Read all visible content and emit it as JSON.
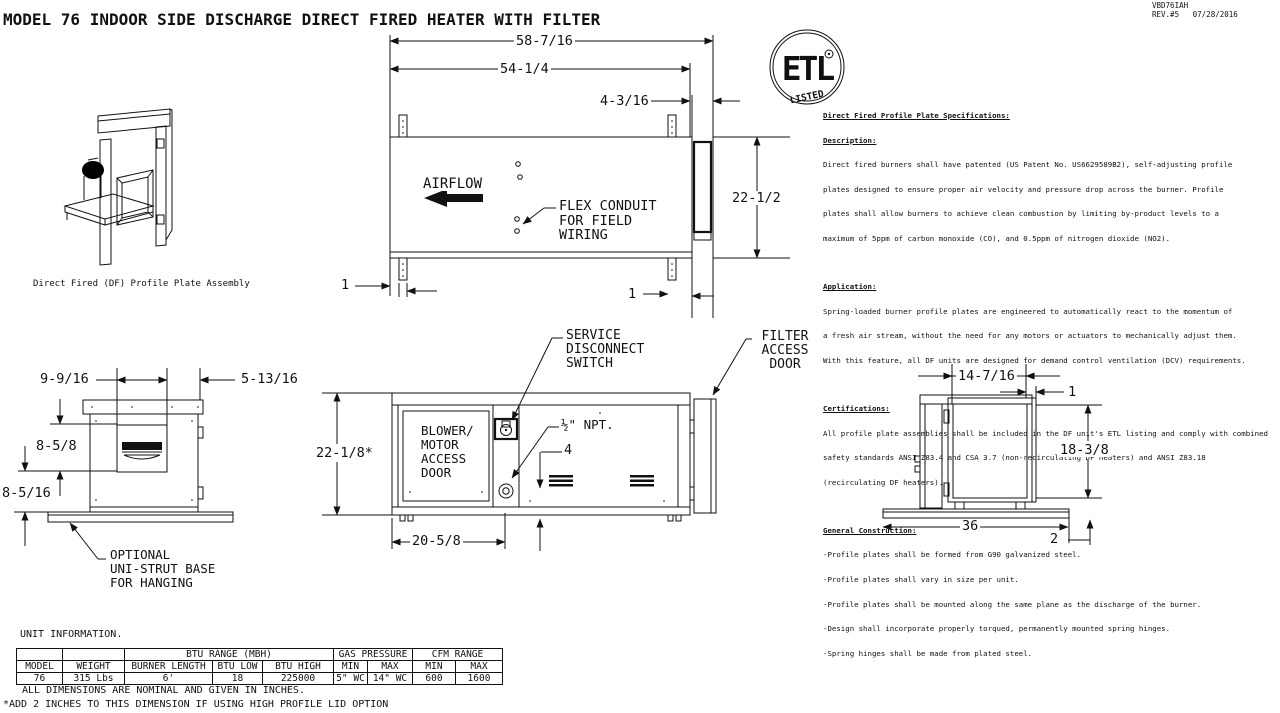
{
  "meta": {
    "title": "MODEL 76 INDOOR SIDE DISCHARGE DIRECT FIRED HEATER WITH FILTER",
    "doc_number": "VBD76IAH",
    "revision": "REV.#5   07/28/2016"
  },
  "etl": {
    "letters": "ETL",
    "listed": "LISTED"
  },
  "specs": {
    "title": "Direct Fired Profile Plate Specifications:",
    "sections": [
      {
        "heading": "Description:",
        "lines": [
          "Direct fired burners shall have patented (US Patent No. US6629589B2), self-adjusting profile",
          "plates designed to ensure proper air velocity and pressure drop across the burner. Profile",
          "plates shall allow burners to achieve clean combustion by limiting by-product levels to a",
          "maximum of 5ppm of carbon monoxide (CO), and 0.5ppm of nitrogen dioxide (NO2)."
        ]
      },
      {
        "heading": "Application:",
        "lines": [
          "Spring-loaded burner profile plates are engineered to automatically react to the momentum of",
          "a fresh air stream, without the need for any motors or actuators to mechanically adjust them.",
          "With this feature, all DF units are designed for demand control ventilation (DCV) requirements."
        ]
      },
      {
        "heading": "Certifications:",
        "lines": [
          "All profile plate assemblies shall be included in the DF unit's ETL listing and comply with combined",
          "safety standards ANSI Z83.4 and CSA 3.7 (non-recirculating DF heaters) and ANSI Z83.18",
          "(recirculating DF heaters)."
        ]
      },
      {
        "heading": "General Construction:",
        "lines": [
          "-Profile plates shall be formed from G90 galvanized steel.",
          "-Profile plates shall vary in size per unit.",
          "-Profile plates shall be mounted along the same plane as the discharge of the burner.",
          "-Design shall incorporate properly torqued, permanently mounted spring hinges.",
          "-Spring hinges shall be made from plated steel."
        ]
      }
    ]
  },
  "iso_view": {
    "caption": "Direct Fired (DF) Profile Plate Assembly"
  },
  "top_view": {
    "dim_overall_width": "58-7/16",
    "dim_body_width": "54-1/4",
    "dim_filter_depth": "4-3/16",
    "dim_height": "22-1/2",
    "dim_bracket_left": "1",
    "dim_bracket_right": "1",
    "airflow_label": "AIRFLOW",
    "flex_conduit_label": "FLEX CONDUIT\nFOR FIELD\nWIRING"
  },
  "left_view": {
    "dim_top_left": "9-9/16",
    "dim_top_right": "5-13/16",
    "dim_mid": "8-5/8",
    "dim_lower": "8-5/16",
    "base_label": "OPTIONAL\nUNI-STRUT BASE\nFOR HANGING"
  },
  "side_view": {
    "dim_height": "22-1/8*",
    "dim_burner": "20-5/8",
    "dim_four": "4",
    "npt_label": "½\" NPT.",
    "service_switch_label": "SERVICE\nDISCONNECT\nSWITCH",
    "filter_door_label": "FILTER\nACCESS\nDOOR",
    "blower_door_label": "BLOWER/\nMOTOR\nACCESS\nDOOR"
  },
  "right_view": {
    "dim_width": "14-7/16",
    "dim_door": "1",
    "dim_height": "18-3/8",
    "dim_base": "36",
    "dim_base_offset": "2"
  },
  "unit_info": {
    "title": "UNIT INFORMATION.",
    "group_headers": {
      "btu": "BTU RANGE (MBH)",
      "gas": "GAS PRESSURE",
      "cfm": "CFM RANGE"
    },
    "headers": [
      "MODEL",
      "WEIGHT",
      "BURNER LENGTH",
      "BTU LOW",
      "BTU HIGH",
      "MIN",
      "MAX",
      "MIN",
      "MAX"
    ],
    "row": [
      "76",
      "315 Lbs",
      "6'",
      "18",
      "225000",
      "5\" WC",
      "14\" WC",
      "600",
      "1600"
    ]
  },
  "notes": [
    "ALL DIMENSIONS ARE NOMINAL AND GIVEN IN INCHES.",
    "*ADD 2 INCHES TO THIS DIMENSION IF USING HIGH PROFILE LID OPTION"
  ]
}
